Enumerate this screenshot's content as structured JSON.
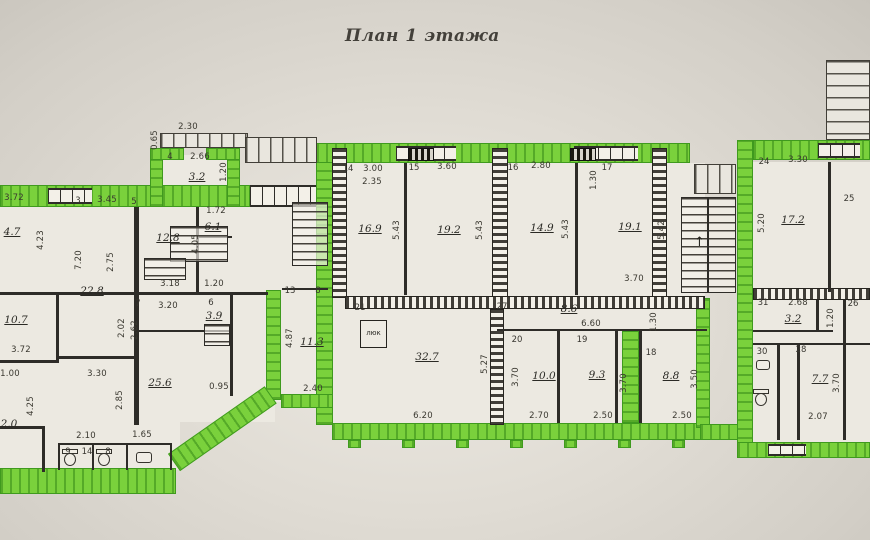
{
  "title": "План 1 этажа",
  "colors": {
    "wall_highlight": "#7ad13c",
    "paper": "#e0dcd4",
    "ink": "#2e2c28"
  },
  "plan": {
    "hatch_label": "люк",
    "stair_arrow": "↑",
    "room_numbers": [
      {
        "n": "3",
        "x": 78,
        "y": 201
      },
      {
        "n": "4",
        "x": 170,
        "y": 157
      },
      {
        "n": "5",
        "x": 134,
        "y": 202
      },
      {
        "n": "6",
        "x": 211,
        "y": 303
      },
      {
        "n": "7",
        "x": 138,
        "y": 304
      },
      {
        "n": "8",
        "x": 318,
        "y": 291
      },
      {
        "n": "13",
        "x": 290,
        "y": 291
      },
      {
        "n": "14",
        "x": 348,
        "y": 169
      },
      {
        "n": "15",
        "x": 414,
        "y": 168
      },
      {
        "n": "16",
        "x": 513,
        "y": 168
      },
      {
        "n": "17",
        "x": 607,
        "y": 168
      },
      {
        "n": "18",
        "x": 651,
        "y": 353
      },
      {
        "n": "19",
        "x": 582,
        "y": 340
      },
      {
        "n": "20",
        "x": 517,
        "y": 340
      },
      {
        "n": "21",
        "x": 360,
        "y": 308
      },
      {
        "n": "24",
        "x": 764,
        "y": 162
      },
      {
        "n": "25",
        "x": 849,
        "y": 199
      },
      {
        "n": "26",
        "x": 853,
        "y": 304
      },
      {
        "n": "27",
        "x": 502,
        "y": 307
      },
      {
        "n": "28",
        "x": 801,
        "y": 350
      },
      {
        "n": "30",
        "x": 762,
        "y": 352
      },
      {
        "n": "31",
        "x": 763,
        "y": 303
      },
      {
        "n": "9",
        "x": 68,
        "y": 452
      },
      {
        "n": "14",
        "x": 87,
        "y": 452
      },
      {
        "n": "8",
        "x": 108,
        "y": 452
      }
    ],
    "room_areas": [
      {
        "a": "3.2",
        "x": 197,
        "y": 177
      },
      {
        "a": "6.1",
        "x": 213,
        "y": 227
      },
      {
        "a": "12.8",
        "x": 168,
        "y": 238
      },
      {
        "a": "22.8",
        "x": 92,
        "y": 291
      },
      {
        "a": "4.7",
        "x": 12,
        "y": 232
      },
      {
        "a": "10.7",
        "x": 16,
        "y": 320
      },
      {
        "a": "2.0",
        "x": 9,
        "y": 424
      },
      {
        "a": "25.6",
        "x": 160,
        "y": 383
      },
      {
        "a": "3.9",
        "x": 214,
        "y": 316
      },
      {
        "a": "11.3",
        "x": 312,
        "y": 342
      },
      {
        "a": "16.9",
        "x": 370,
        "y": 229
      },
      {
        "a": "19.2",
        "x": 449,
        "y": 230
      },
      {
        "a": "14.9",
        "x": 542,
        "y": 228
      },
      {
        "a": "19.1",
        "x": 630,
        "y": 227
      },
      {
        "a": "17.2",
        "x": 793,
        "y": 220
      },
      {
        "a": "32.7",
        "x": 427,
        "y": 357
      },
      {
        "a": "8.6",
        "x": 569,
        "y": 309
      },
      {
        "a": "10.0",
        "x": 544,
        "y": 376
      },
      {
        "a": "9.3",
        "x": 597,
        "y": 375
      },
      {
        "a": "8.8",
        "x": 671,
        "y": 376
      },
      {
        "a": "3.2",
        "x": 793,
        "y": 319
      },
      {
        "a": "7.7",
        "x": 820,
        "y": 379
      }
    ],
    "dimensions": [
      {
        "t": "2.30",
        "x": 188,
        "y": 127
      },
      {
        "t": "0.65",
        "x": 155,
        "y": 140,
        "v": 1
      },
      {
        "t": "2.66",
        "x": 200,
        "y": 157
      },
      {
        "t": "1.20",
        "x": 224,
        "y": 172,
        "v": 1
      },
      {
        "t": "3.45",
        "x": 107,
        "y": 200
      },
      {
        "t": "1.72",
        "x": 216,
        "y": 211
      },
      {
        "t": "4.05",
        "x": 196,
        "y": 244,
        "v": 1
      },
      {
        "t": "3.18",
        "x": 170,
        "y": 284
      },
      {
        "t": "1.20",
        "x": 214,
        "y": 284
      },
      {
        "t": "3.72",
        "x": 14,
        "y": 198
      },
      {
        "t": "4.23",
        "x": 41,
        "y": 240,
        "v": 1
      },
      {
        "t": "7.20",
        "x": 79,
        "y": 260,
        "v": 1
      },
      {
        "t": "2.75",
        "x": 111,
        "y": 262,
        "v": 1
      },
      {
        "t": "3.20",
        "x": 168,
        "y": 306
      },
      {
        "t": "2.02",
        "x": 122,
        "y": 328,
        "v": 1
      },
      {
        "t": "2.62",
        "x": 135,
        "y": 330,
        "v": 1
      },
      {
        "t": "3.30",
        "x": 97,
        "y": 374
      },
      {
        "t": "3.72",
        "x": 21,
        "y": 350
      },
      {
        "t": "1.00",
        "x": 10,
        "y": 374
      },
      {
        "t": "4.25",
        "x": 31,
        "y": 406,
        "v": 1
      },
      {
        "t": "2.85",
        "x": 120,
        "y": 400,
        "v": 1
      },
      {
        "t": "2.10",
        "x": 86,
        "y": 436
      },
      {
        "t": "1.65",
        "x": 142,
        "y": 435
      },
      {
        "t": "0.95",
        "x": 219,
        "y": 387
      },
      {
        "t": "4.87",
        "x": 290,
        "y": 338,
        "v": 1
      },
      {
        "t": "2.40",
        "x": 313,
        "y": 389
      },
      {
        "t": "3.00",
        "x": 373,
        "y": 169
      },
      {
        "t": "2.35",
        "x": 372,
        "y": 182
      },
      {
        "t": "3.60",
        "x": 447,
        "y": 167
      },
      {
        "t": "5.43",
        "x": 397,
        "y": 230,
        "v": 1
      },
      {
        "t": "5.43",
        "x": 480,
        "y": 230,
        "v": 1
      },
      {
        "t": "2.80",
        "x": 541,
        "y": 166
      },
      {
        "t": "1.30",
        "x": 594,
        "y": 180,
        "v": 1
      },
      {
        "t": "5.43",
        "x": 566,
        "y": 229,
        "v": 1
      },
      {
        "t": "5.42",
        "x": 662,
        "y": 230,
        "v": 1
      },
      {
        "t": "3.70",
        "x": 634,
        "y": 279
      },
      {
        "t": "6.60",
        "x": 591,
        "y": 324
      },
      {
        "t": "5.27",
        "x": 485,
        "y": 364,
        "v": 1
      },
      {
        "t": "6.20",
        "x": 423,
        "y": 416
      },
      {
        "t": "3.70",
        "x": 516,
        "y": 377,
        "v": 1
      },
      {
        "t": "2.70",
        "x": 539,
        "y": 416
      },
      {
        "t": "3.70",
        "x": 624,
        "y": 383,
        "v": 1
      },
      {
        "t": "2.50",
        "x": 603,
        "y": 416
      },
      {
        "t": "1.30",
        "x": 654,
        "y": 322,
        "v": 1
      },
      {
        "t": "3.50",
        "x": 695,
        "y": 379,
        "v": 1
      },
      {
        "t": "2.50",
        "x": 682,
        "y": 416
      },
      {
        "t": "3.30",
        "x": 798,
        "y": 160
      },
      {
        "t": "5.20",
        "x": 762,
        "y": 223,
        "v": 1
      },
      {
        "t": "2.68",
        "x": 798,
        "y": 303
      },
      {
        "t": "1.20",
        "x": 831,
        "y": 318,
        "v": 1
      },
      {
        "t": "3.70",
        "x": 837,
        "y": 383,
        "v": 1
      },
      {
        "t": "2.07",
        "x": 818,
        "y": 417
      }
    ]
  }
}
